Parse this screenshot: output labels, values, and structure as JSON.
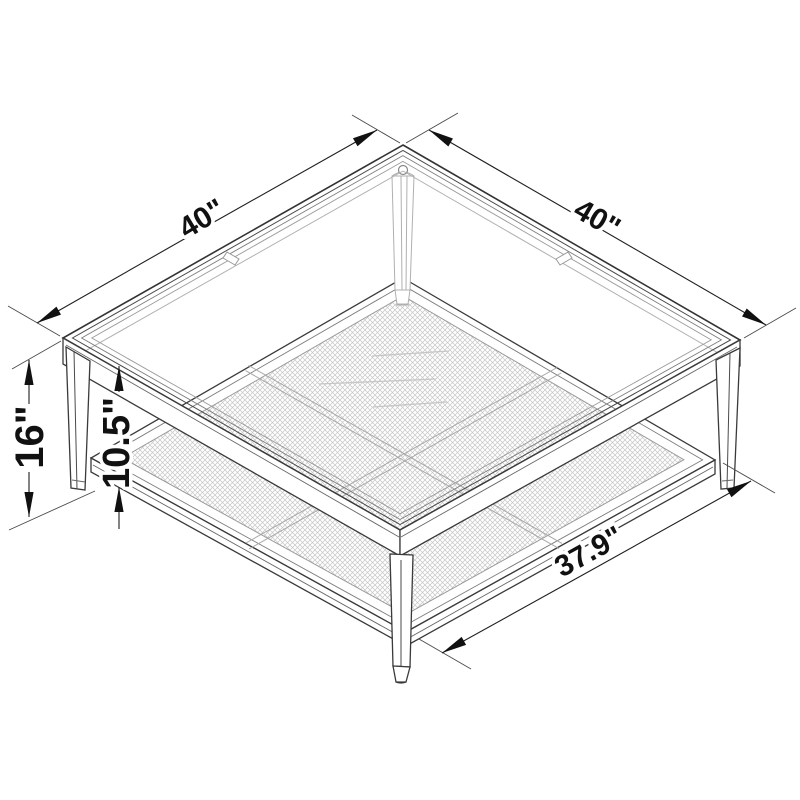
{
  "diagram": {
    "description": "Isometric dimension drawing of a square coffee table with glass top and metal mesh shelf",
    "labels": {
      "top_width_left": "40\"",
      "top_width_right": "40\"",
      "overall_height": "16\"",
      "shelf_clearance": "10.5\"",
      "shelf_width": "37.9\""
    },
    "colors": {
      "background": "#ffffff",
      "line": "#3a3a3a",
      "dimension": "#1f1f1f",
      "hidden_line": "#b0b0b0",
      "mesh": "#c5c5c5"
    }
  }
}
